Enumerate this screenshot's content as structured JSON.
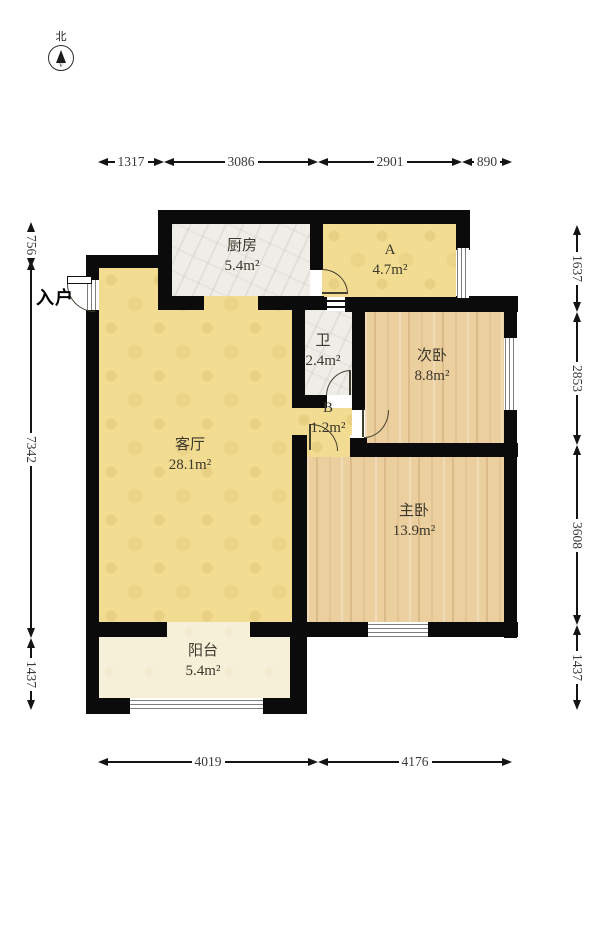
{
  "compass": {
    "label": "北"
  },
  "entrance": {
    "label": "入户"
  },
  "rooms": {
    "kitchen": {
      "name": "厨房",
      "area": "5.4m²"
    },
    "room_a": {
      "name": "A",
      "area": "4.7m²"
    },
    "bathroom": {
      "name": "卫",
      "area": "2.4m²"
    },
    "second_bedroom": {
      "name": "次卧",
      "area": "8.8m²"
    },
    "hall_b": {
      "name": "B",
      "area": "1.2m²"
    },
    "living_room": {
      "name": "客厅",
      "area": "28.1m²"
    },
    "master_bedroom": {
      "name": "主卧",
      "area": "13.9m²"
    },
    "balcony": {
      "name": "阳台",
      "area": "5.4m²"
    }
  },
  "dimensions": {
    "top": [
      "1317",
      "3086",
      "2901",
      "890"
    ],
    "left": [
      "756",
      "7342",
      "1437"
    ],
    "right": [
      "1637",
      "2853",
      "3608",
      "1437"
    ],
    "bottom": [
      "4019",
      "4176"
    ]
  },
  "colors": {
    "wall": "#0b0b0b",
    "living_floor": "#f2dc92",
    "tile_floor": "#efede8",
    "wood_floor": "#ebcf9f",
    "balcony_floor": "#f7f0d8"
  }
}
